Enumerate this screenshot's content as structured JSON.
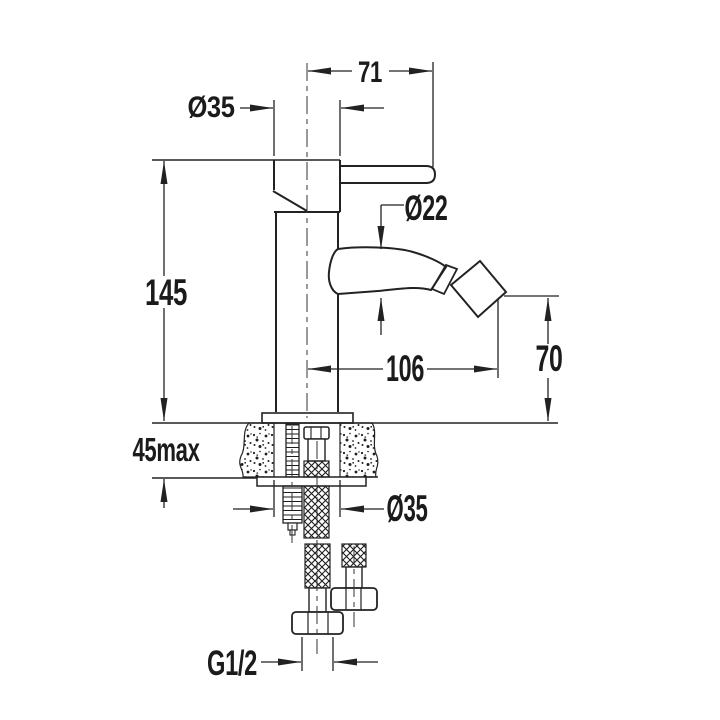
{
  "drawing": {
    "type": "technical-dimension-drawing",
    "subject": "Single-lever bidet mixer tap — side elevation with deck mounting cross-section",
    "background_color": "#ffffff",
    "line_color": "#222222",
    "dimensions": {
      "lever_reach": "71",
      "body_diameter_top": "Ø35",
      "spout_diameter": "Ø22",
      "body_height": "145",
      "spout_reach": "106",
      "spout_outlet_height": "70",
      "deck_thickness_max": "45max",
      "mounting_hole_diameter": "Ø35",
      "connection_thread": "G1/2"
    }
  }
}
